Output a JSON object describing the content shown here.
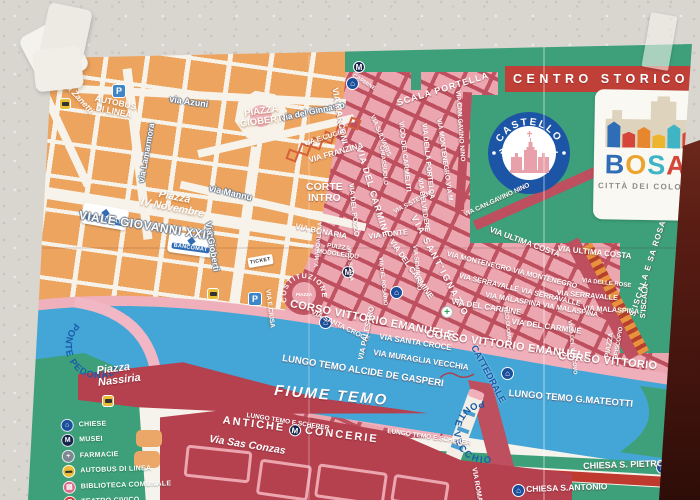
{
  "map": {
    "banner": {
      "text": "CENTRO STORICO"
    },
    "logo": {
      "letters": [
        {
          "ch": "B",
          "color": "#2f6db6"
        },
        {
          "ch": "O",
          "color": "#eda42e"
        },
        {
          "ch": "S",
          "color": "#3fb4c4"
        },
        {
          "ch": "A",
          "color": "#d6453a"
        }
      ],
      "subtitle": "CITTÀ DEI COLORI",
      "houses": [
        {
          "color": "#2f6db6",
          "h": 26
        },
        {
          "color": "#d6453a",
          "h": 16
        },
        {
          "color": "#e8862e",
          "h": 21
        },
        {
          "color": "#edb52e",
          "h": 14
        },
        {
          "color": "#3fb4c4",
          "h": 24
        },
        {
          "color": "#d6453a",
          "h": 18
        }
      ]
    },
    "badge": {
      "line1": "CASTELLO",
      "line2": "MALASPINA"
    },
    "curved": {
      "ponte_pedonale": "PONTE PEDONALE",
      "ponte_vecchio": "PONTE VECCHIO",
      "costituzione": "COSTITUZIONE",
      "piazza_center": "PIAZZA"
    },
    "antiche": {
      "left": "ANTICHE",
      "m": "M",
      "right": "CONCERIE"
    },
    "badges": {
      "bancomat": "BANCOMAT",
      "ticket": "TICKET"
    },
    "legend": {
      "items": [
        {
          "icon": "church",
          "label": "CHIESE"
        },
        {
          "icon": "museum",
          "label": "MUSEI"
        },
        {
          "icon": "pharmacy",
          "label": "FARMACIE"
        },
        {
          "icon": "busstop",
          "label": "AUTOBUS DI LINEA"
        },
        {
          "icon": "library",
          "label": "BIBLIOTECA COMUNALE"
        },
        {
          "icon": "theater",
          "label": "TEATRO CIVICO"
        }
      ]
    },
    "colors": {
      "green": "#3da07a",
      "old_town_red": "#bd4f5e",
      "building_pink": "#eba6b0",
      "modern_orange": "#eda45f",
      "river_blue": "#44a6d6",
      "banner_red": "#c04038",
      "dark_red": "#b5404e",
      "label_blue": "#1a5cab"
    },
    "labels": [
      {
        "t": "Piazza Zanetti",
        "x": 57,
        "y": 68,
        "r": 47,
        "fs": 8.5,
        "cls": "wt it"
      },
      {
        "lines": [
          "AUTOBUS",
          "DI LINEA"
        ],
        "x": 96,
        "y": 94,
        "r": 12,
        "fs": 8.5,
        "cls": "wt ctr"
      },
      {
        "t": "via Azuni",
        "x": 170,
        "y": 95,
        "r": 8,
        "fs": 9,
        "cls": "onstreet"
      },
      {
        "t": "via Lamarmora",
        "x": 137,
        "y": 182,
        "r": -80,
        "fs": 8.5,
        "cls": "onstreet"
      },
      {
        "t": "via del Ginnasio",
        "x": 280,
        "y": 114,
        "r": -12,
        "fs": 8.5,
        "cls": "onstreet"
      },
      {
        "lines": [
          "PIAZZA",
          "GIOBERTI"
        ],
        "x": 238,
        "y": 110,
        "r": -8,
        "fs": 9.5,
        "cls": "wt ctr"
      },
      {
        "t": "via Mannu",
        "x": 210,
        "y": 184,
        "r": 13,
        "fs": 9,
        "cls": "onstreet"
      },
      {
        "lines": [
          "Piazza",
          "IV Novembre"
        ],
        "x": 144,
        "y": 186,
        "r": 11,
        "fs": 10.5,
        "cls": "wt ctr it"
      },
      {
        "t": "VIALE GIOVANNI XXIII",
        "x": 80,
        "y": 209,
        "r": 9,
        "fs": 12,
        "ls": 0.5,
        "cls": "onstreet"
      },
      {
        "t": "Via Gioberti",
        "x": 212,
        "y": 221,
        "r": 80,
        "fs": 9,
        "cls": "onstreet"
      },
      {
        "t": "VIA E.CIUSA",
        "x": 271,
        "y": 289,
        "r": 83,
        "fs": 6.5,
        "cls": "wt"
      },
      {
        "t": "VIA MARCONI",
        "x": 339,
        "y": 87,
        "r": 80,
        "fs": 8.5
      },
      {
        "t": "SCALA PORTELLA",
        "x": 396,
        "y": 99,
        "r": -17,
        "fs": 9,
        "ls": 1
      },
      {
        "t": "CARMINE",
        "x": 354,
        "y": 74,
        "r": 32,
        "fs": 5.5
      },
      {
        "t": "VIA E.CUGIA",
        "x": 303,
        "y": 141,
        "r": -17,
        "fs": 7
      },
      {
        "t": "VIA FRANZINA",
        "x": 308,
        "y": 157,
        "r": -16,
        "fs": 8
      },
      {
        "lines": [
          "CORTE",
          "INTRO"
        ],
        "x": 306,
        "y": 182,
        "r": 0,
        "fs": 10.5,
        "cls": "st ctr"
      },
      {
        "t": "VIA BONARIA",
        "x": 296,
        "y": 223,
        "r": 11,
        "fs": 8
      },
      {
        "t": "VIA FONTE",
        "x": 368,
        "y": 233,
        "r": -7,
        "fs": 7.5
      },
      {
        "t": "V. MADDALENA",
        "x": 314,
        "y": 267,
        "r": -85,
        "fs": 6
      },
      {
        "lines": [
          "PIAZZA",
          "MODOLEDDU"
        ],
        "x": 318,
        "y": 241,
        "r": 8,
        "fs": 6.5,
        "cls": "st ctr"
      },
      {
        "t": "VICO SCALA",
        "x": 350,
        "y": 247,
        "r": 85,
        "fs": 5.5
      },
      {
        "t": "VIA DEL POZZO",
        "x": 354,
        "y": 183,
        "r": 84,
        "fs": 7
      },
      {
        "t": "VIA DEL CARMINE",
        "x": 363,
        "y": 146,
        "r": 73,
        "fs": 9,
        "ls": 1
      },
      {
        "t": "VIA SULVARIS",
        "x": 375,
        "y": 114,
        "r": 67,
        "fs": 6.5
      },
      {
        "t": "CHIASSUOLO",
        "x": 384,
        "y": 145,
        "r": 84,
        "fs": 6
      },
      {
        "t": "VICO DEI CARMELITI",
        "x": 404,
        "y": 121,
        "r": 84,
        "fs": 7
      },
      {
        "t": "VIA DELLA PORTELLA",
        "x": 427,
        "y": 123,
        "r": 84,
        "fs": 7
      },
      {
        "t": "VIA MONTENEGRO VIA M.",
        "x": 442,
        "y": 118,
        "r": 82,
        "fs": 6.8
      },
      {
        "t": "VIA S.STEFANO",
        "x": 393,
        "y": 210,
        "r": -28,
        "fs": 6
      },
      {
        "t": "VIA DEL ROSARIO",
        "x": 382,
        "y": 257,
        "r": 84,
        "fs": 5.5
      },
      {
        "t": "VIA SEMINARIO",
        "x": 417,
        "y": 245,
        "r": 84,
        "fs": 6
      },
      {
        "t": "VIA SANT'IGNAZIO",
        "x": 417,
        "y": 214,
        "r": 62,
        "fs": 9,
        "ls": 2
      },
      {
        "t": "VIA DEL CARMINE",
        "x": 394,
        "y": 238,
        "r": 55,
        "fs": 8
      },
      {
        "t": "VIA BELVEDERE",
        "x": 423,
        "y": 178,
        "r": 82,
        "fs": 6.8
      },
      {
        "t": "VIA CAN.GAVINO NINO",
        "x": 461,
        "y": 90,
        "r": 86,
        "fs": 6.5
      },
      {
        "t": "VIA CAN.GAVINO NINO",
        "x": 463,
        "y": 212,
        "r": -25,
        "fs": 6.5
      },
      {
        "t": "VIA ULTIMA COSTA",
        "x": 491,
        "y": 226,
        "r": 20,
        "fs": 8
      },
      {
        "t": "VIA ULTIMA COSTA",
        "x": 558,
        "y": 245,
        "r": 6,
        "fs": 8
      },
      {
        "t": "VIA MONTENEGRO VIA MONTENEGRO",
        "x": 448,
        "y": 250,
        "r": 14,
        "fs": 7.2
      },
      {
        "t": "VIA SERRAVALLE VIA SERRAVALLE",
        "x": 460,
        "y": 272,
        "r": 13,
        "fs": 7.2
      },
      {
        "t": "VIA SERRAVALLE",
        "x": 557,
        "y": 289,
        "r": 5,
        "fs": 7.2
      },
      {
        "t": "VIA MALASPINA VIA MALASPINA",
        "x": 486,
        "y": 291,
        "r": 10,
        "fs": 7.2
      },
      {
        "t": "VIA MALASPINA",
        "x": 583,
        "y": 304,
        "r": 4,
        "fs": 7.2
      },
      {
        "t": "VIA DELLE ROSE",
        "x": 582,
        "y": 278,
        "r": 6,
        "fs": 6
      },
      {
        "t": "S'ISCALA E SA ROSA",
        "x": 629,
        "y": 315,
        "r": -72,
        "fs": 8,
        "ls": 1
      },
      {
        "t": "S'ISCALA",
        "x": 639,
        "y": 318,
        "r": -85,
        "fs": 7.5
      },
      {
        "t": "VIA DEL CARMINE",
        "x": 452,
        "y": 298,
        "r": 9,
        "fs": 8
      },
      {
        "t": "VIA DEL CARMINE",
        "x": 512,
        "y": 318,
        "r": 8,
        "fs": 8
      },
      {
        "t": "VICO DUOMO",
        "x": 507,
        "y": 306,
        "r": 84,
        "fs": 5.5
      },
      {
        "t": "VICO DEL VESCOVO",
        "x": 571,
        "y": 320,
        "r": 84,
        "fs": 5.5
      },
      {
        "t": "PIAZZA",
        "x": 604,
        "y": 357,
        "r": -80,
        "fs": 7
      },
      {
        "t": "EPISCOPIO",
        "x": 613,
        "y": 359,
        "r": -80,
        "fs": 6
      },
      {
        "t": "CORSO VITTORIO EMANUELE",
        "x": 291,
        "y": 299,
        "r": 11,
        "fs": 11,
        "ls": 0.3
      },
      {
        "t": "CORSO VITTORIO EMANUELE",
        "x": 427,
        "y": 329,
        "r": 8,
        "fs": 11,
        "ls": 0.3
      },
      {
        "t": "CORSO VITTORIO",
        "x": 559,
        "y": 351,
        "r": 6,
        "fs": 11,
        "ls": 0.3
      },
      {
        "t": "VIA SANTA CROCE",
        "x": 313,
        "y": 309,
        "r": 26,
        "fs": 7
      },
      {
        "t": "VIA SANTA CROCE",
        "x": 380,
        "y": 333,
        "r": 9,
        "fs": 8
      },
      {
        "t": "VIA MURAGLIA VECCHIA",
        "x": 374,
        "y": 349,
        "r": 9,
        "fs": 8
      },
      {
        "t": "VIA PALESTRO",
        "x": 357,
        "y": 359,
        "r": -78,
        "fs": 7.5
      },
      {
        "t": "LUNGO TEMO ALCIDE DE GASPERI",
        "x": 283,
        "y": 354,
        "r": 9,
        "fs": 9.5
      },
      {
        "t": "LUNGO TEMO G.MATEOTTI",
        "x": 509,
        "y": 389,
        "r": 5,
        "fs": 9.5
      },
      {
        "t": "CATTEDRALE",
        "x": 477,
        "y": 344,
        "r": 62,
        "fs": 9.5,
        "cls": "blue"
      },
      {
        "t": "VIA ROMA",
        "x": 477,
        "y": 467,
        "r": 80,
        "fs": 7
      },
      {
        "t": "CHIESA S. PIETRO",
        "x": 583,
        "y": 462,
        "r": -2,
        "fs": 9
      },
      {
        "t": "CHIESA S.ANTONIO",
        "x": 526,
        "y": 485,
        "r": -2,
        "fs": 8.5
      },
      {
        "t": "LUNGO TEMO E.SCHERER",
        "x": 247,
        "y": 412,
        "r": 9,
        "fs": 6.5
      },
      {
        "t": "LUNGO TEMO E.SCHERER",
        "x": 388,
        "y": 428,
        "r": 8,
        "fs": 6.5
      },
      {
        "t": "FIUME TEMO",
        "x": 275,
        "y": 383,
        "r": 5,
        "fs": 15,
        "ls": 2,
        "cls": "st it"
      },
      {
        "lines": [
          "Piazza",
          "Nassiria"
        ],
        "x": 96,
        "y": 366,
        "r": -7,
        "fs": 11,
        "cls": "st it"
      },
      {
        "t": "Via Sas Conzas",
        "x": 210,
        "y": 434,
        "r": 9,
        "fs": 10.5,
        "cls": "st it"
      }
    ],
    "icons": [
      {
        "type": "parking",
        "x": 112,
        "y": 84
      },
      {
        "type": "parking",
        "x": 248,
        "y": 292
      },
      {
        "type": "bus",
        "x": 59,
        "y": 98
      },
      {
        "type": "bus",
        "x": 207,
        "y": 288
      },
      {
        "type": "bus",
        "x": 102,
        "y": 395
      },
      {
        "type": "church",
        "x": 346,
        "y": 77
      },
      {
        "type": "church",
        "x": 319,
        "y": 316
      },
      {
        "type": "church",
        "x": 390,
        "y": 286
      },
      {
        "type": "church",
        "x": 501,
        "y": 367
      },
      {
        "type": "church",
        "x": 656,
        "y": 461
      },
      {
        "type": "church",
        "x": 512,
        "y": 484
      },
      {
        "type": "mcircle",
        "x": 353,
        "y": 61
      },
      {
        "type": "mcircle",
        "x": 342,
        "y": 266
      },
      {
        "type": "cross",
        "x": 441,
        "y": 306
      },
      {
        "type": "bancomat",
        "x": 82,
        "y": 206,
        "r": 10
      },
      {
        "type": "bancomat",
        "x": 168,
        "y": 234,
        "r": 8
      },
      {
        "type": "ticket",
        "x": 248,
        "y": 256,
        "r": -10
      },
      {
        "type": "sq",
        "x": 287,
        "y": 150
      },
      {
        "type": "sq",
        "x": 299,
        "y": 144
      },
      {
        "type": "sq",
        "x": 311,
        "y": 138
      },
      {
        "type": "sq",
        "x": 323,
        "y": 132
      },
      {
        "type": "sq",
        "x": 336,
        "y": 125
      },
      {
        "type": "sq",
        "x": 349,
        "y": 118
      }
    ]
  }
}
